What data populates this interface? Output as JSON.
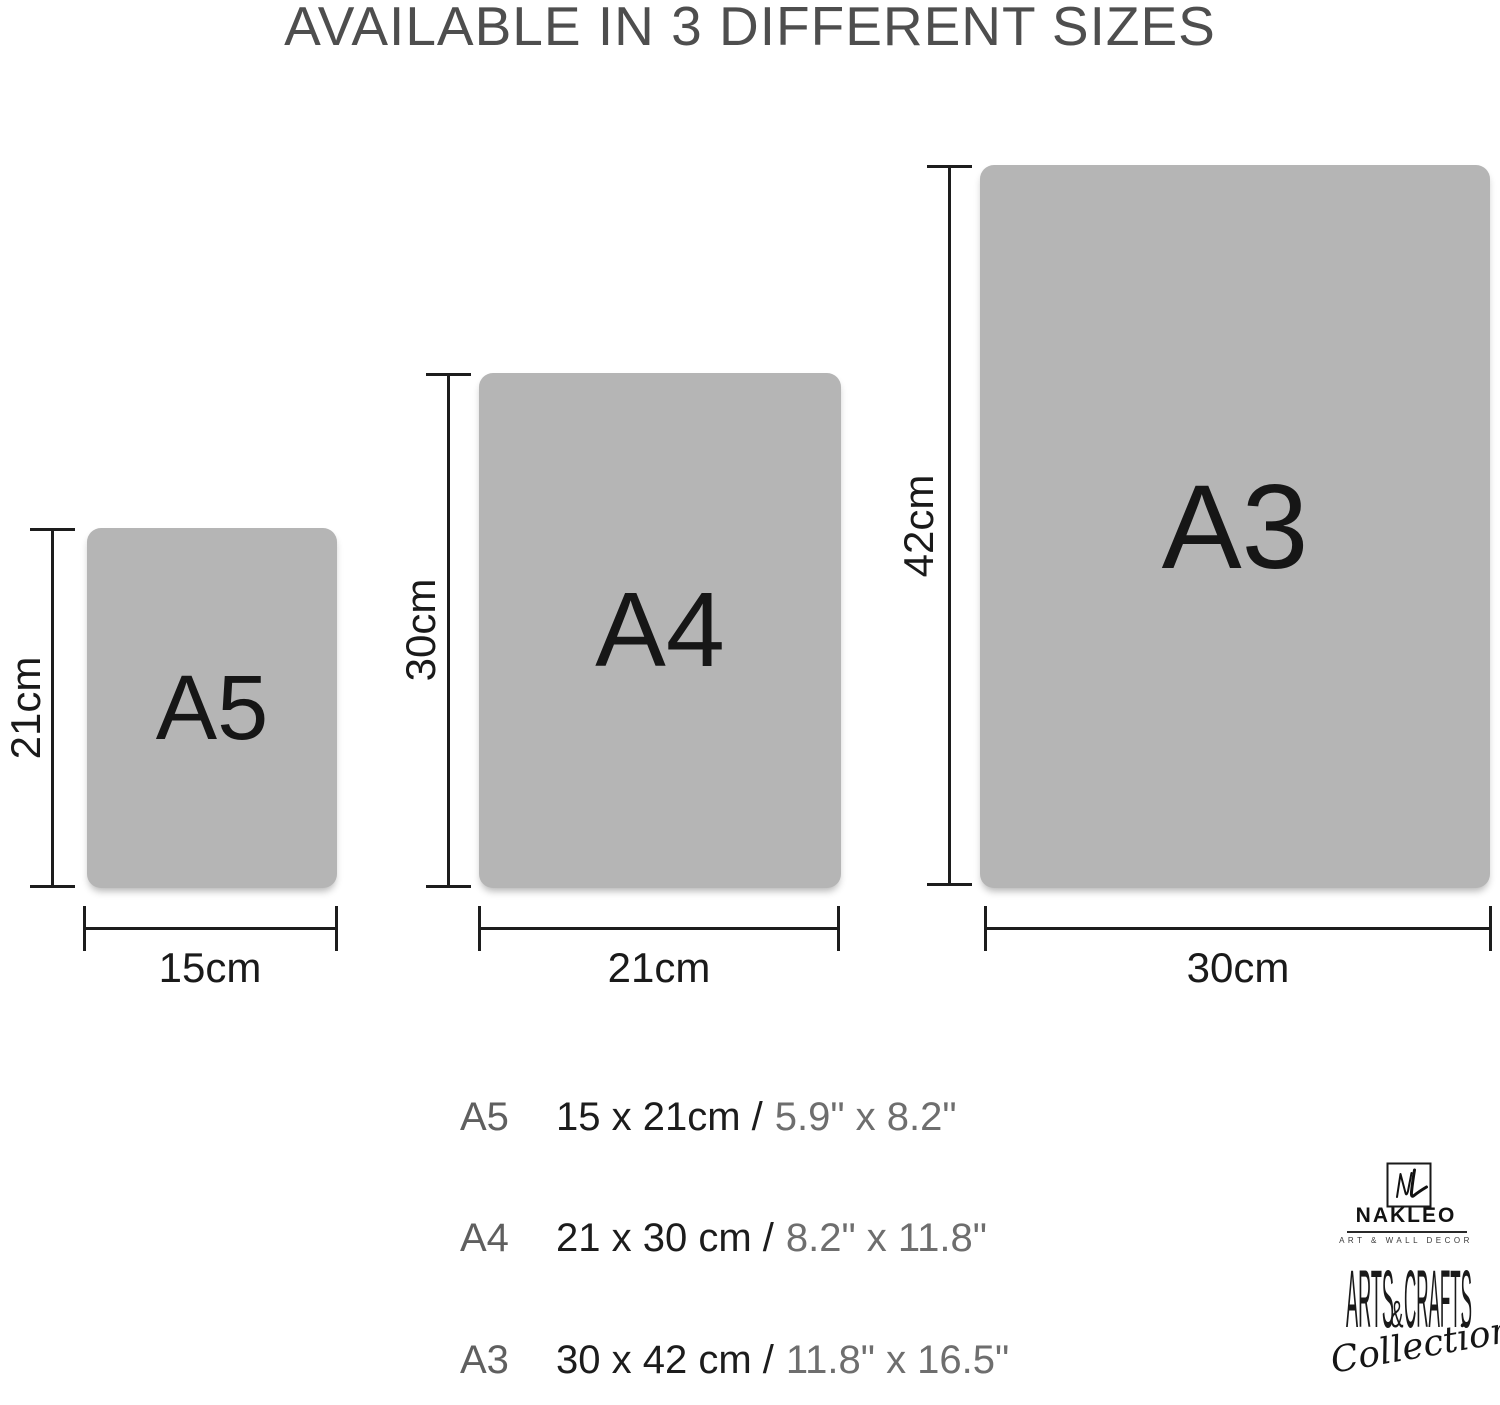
{
  "title": "AVAILABLE IN 3 DIFFERENT SIZES",
  "sizes": [
    {
      "name": "A5",
      "height_cm_label": "21cm",
      "width_cm_label": "15cm",
      "spec_cm": "15 x 21cm /",
      "spec_inch": "5.9\" x 8.2\""
    },
    {
      "name": "A4",
      "height_cm_label": "30cm",
      "width_cm_label": "21cm",
      "spec_cm": "21 x 30 cm /",
      "spec_inch": "8.2\" x 11.8\""
    },
    {
      "name": "A3",
      "height_cm_label": "42cm",
      "width_cm_label": "30cm",
      "spec_cm": "30 x 42 cm /",
      "spec_inch": "11.8\" x 16.5\""
    }
  ],
  "brand": {
    "name": "NAKLEO",
    "tagline": "ART & WALL DECOR",
    "collection_part1": "ARTS",
    "collection_amp": "&",
    "collection_part2": "CRAFTS",
    "collection_script": "Collection"
  },
  "colors": {
    "paper_fill": "#b5b5b5",
    "line": "#1d1d1d",
    "title_text": "#4e4e4e",
    "dark_text": "#1c1c1c",
    "gray_text": "#6e6e6e"
  }
}
